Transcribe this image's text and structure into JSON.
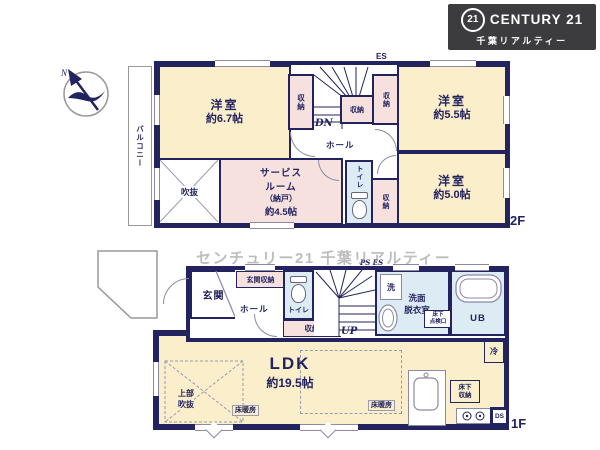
{
  "logo": {
    "seal": "21",
    "brand": "CENTURY 21",
    "subtitle": "千葉リアルティー"
  },
  "compass": {
    "north": "N"
  },
  "watermark": {
    "text": "センチュリー21 千葉リアルティー"
  },
  "colors": {
    "wall": "#23235f",
    "room_cream": "#faeecb",
    "closet_pink": "#f7e1df",
    "wet_blue": "#ddecf4",
    "logo_bg": "#3c3c3e",
    "watermark_gray": "#87878c"
  },
  "floor2": {
    "floor_label": "2F",
    "balcony": "バルコニー",
    "room_67": {
      "name": "洋室",
      "size": "約6.7帖"
    },
    "room_55": {
      "name": "洋室",
      "size": "約5.5帖"
    },
    "room_50": {
      "name": "洋室",
      "size": "約5.0帖"
    },
    "service_room": {
      "name1": "サービス",
      "name2": "ルーム",
      "name3": "（納戸）",
      "size": "約4.5帖"
    },
    "void": "吹抜",
    "hall": "ホール",
    "toilet": "トイレ",
    "closet": "収納",
    "stairs_down": "DN",
    "es": "ES"
  },
  "floor1": {
    "floor_label": "1F",
    "entrance": "玄関",
    "entrance_storage": "玄関収納",
    "hall": "ホール",
    "toilet": "トイレ",
    "closet": "収納",
    "stairs_up": "UP",
    "ps_es": "PS ES",
    "washer": "洗",
    "washroom1": "洗面",
    "washroom2": "脱衣室",
    "hatch1": "床下",
    "hatch2": "点検口",
    "bath": "UB",
    "fridge": "冷",
    "ldk": {
      "name": "LDK",
      "size": "約19.5帖"
    },
    "upper_void1": "上部",
    "upper_void2": "吹抜",
    "floor_heating": "床暖房",
    "underfloor1": "床下",
    "underfloor2": "収納",
    "ds": "DS"
  }
}
